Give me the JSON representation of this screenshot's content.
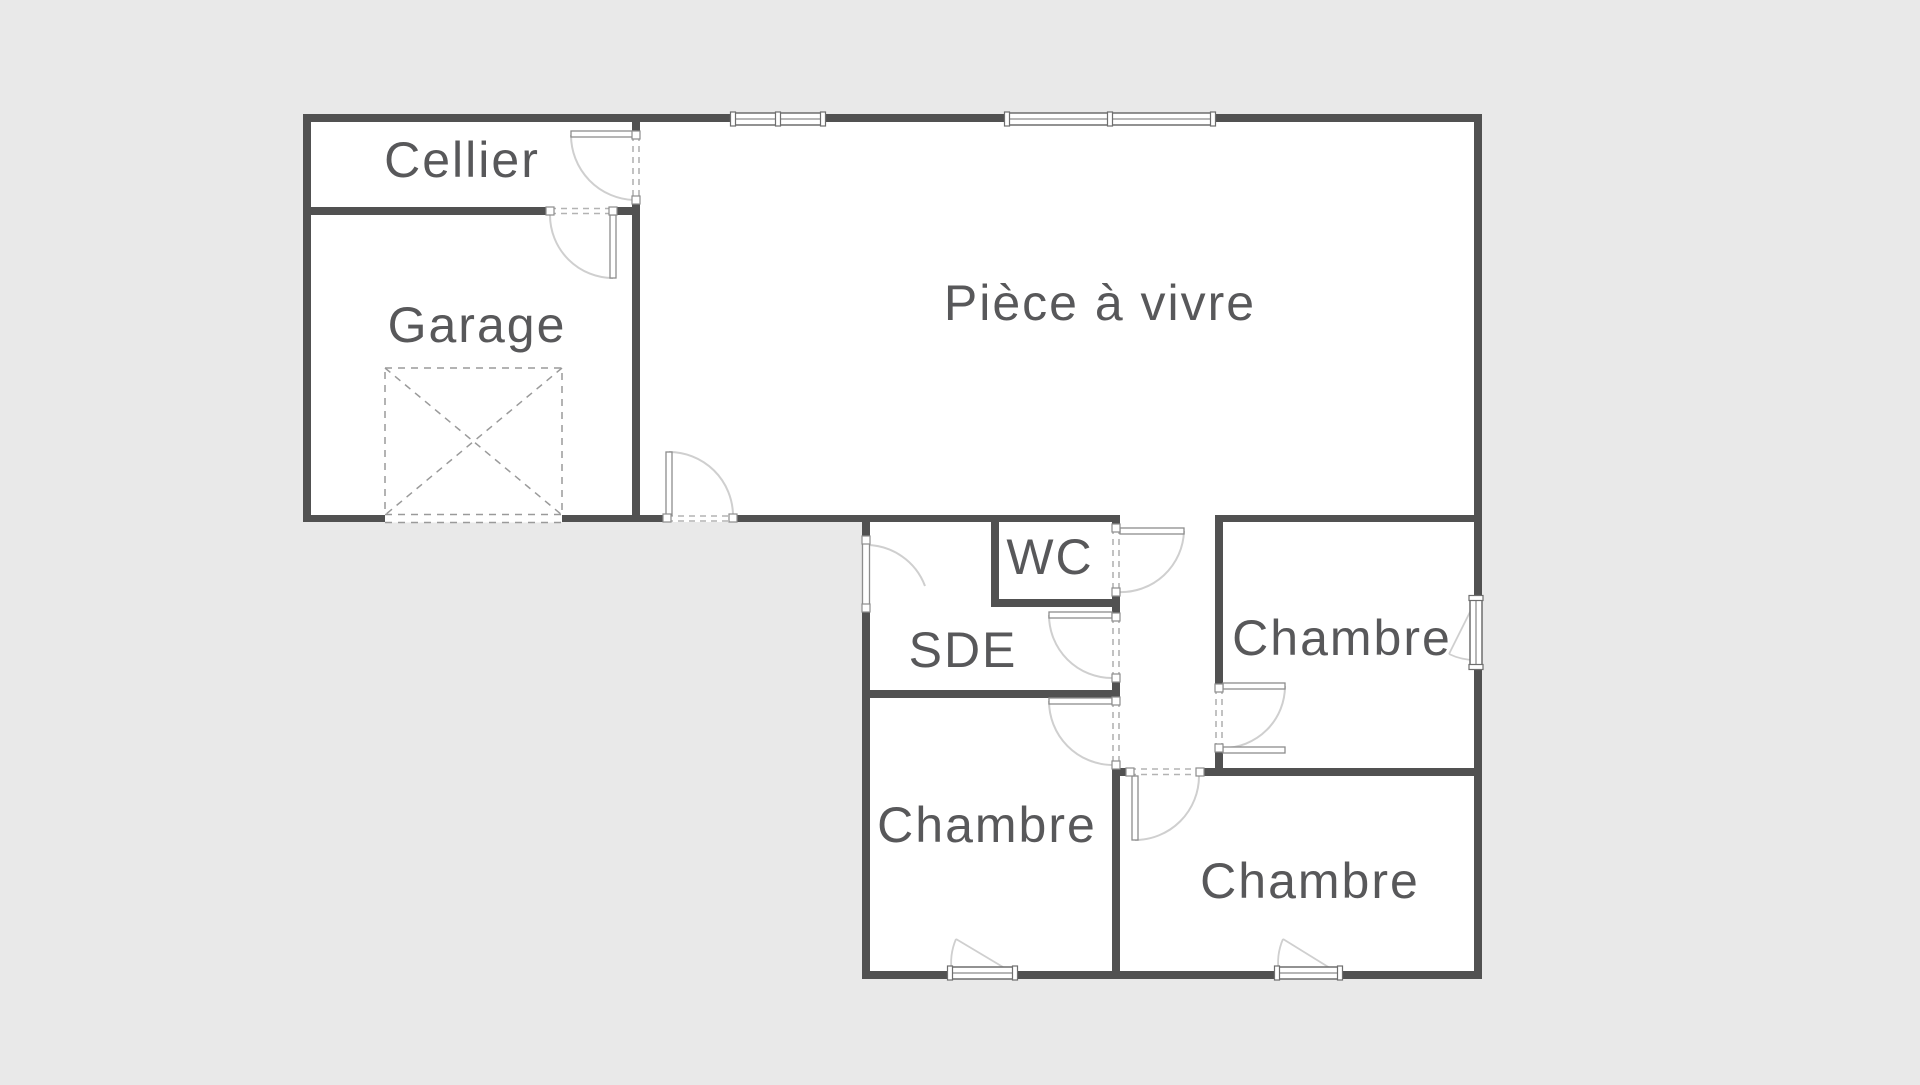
{
  "title": "floor-plan",
  "colors": {
    "background": "#e9e9e9",
    "floor": "#ffffff",
    "wall": "#515151",
    "label": "#58585a",
    "arc": "#cfcfcf",
    "dash": "#b3b3b3",
    "window_stroke": "#6e6e6e",
    "leaf_stroke": "#8d8d8d",
    "parking_dash": "#9a9a9a"
  },
  "label_font_size": 50,
  "rooms": [
    {
      "id": "cellier",
      "label": "Cellier",
      "cx": 462,
      "cy": 160
    },
    {
      "id": "garage",
      "label": "Garage",
      "cx": 477,
      "cy": 325
    },
    {
      "id": "piece-a-vivre",
      "label": "Pièce à vivre",
      "cx": 1100,
      "cy": 303
    },
    {
      "id": "wc",
      "label": "WC",
      "cx": 1050,
      "cy": 557
    },
    {
      "id": "sde",
      "label": "SDE",
      "cx": 963,
      "cy": 650
    },
    {
      "id": "chambre-droite",
      "label": "Chambre",
      "cx": 1342,
      "cy": 638
    },
    {
      "id": "chambre-bas-gauche",
      "label": "Chambre",
      "cx": 987,
      "cy": 825
    },
    {
      "id": "chambre-bas-droite",
      "label": "Chambre",
      "cx": 1310,
      "cy": 881
    }
  ],
  "floor_blocks": [
    {
      "x": 303,
      "y": 114,
      "w": 1179,
      "h": 408
    },
    {
      "x": 862,
      "y": 515,
      "w": 620,
      "h": 464
    }
  ],
  "walls": [
    {
      "x": 303,
      "y": 114,
      "w": 1179,
      "h": 8
    },
    {
      "x": 303,
      "y": 207,
      "w": 247,
      "h": 8
    },
    {
      "x": 613,
      "y": 207,
      "w": 27,
      "h": 8
    },
    {
      "x": 303,
      "y": 515,
      "w": 364,
      "h": 7
    },
    {
      "x": 733,
      "y": 515,
      "w": 387,
      "h": 7
    },
    {
      "x": 1215,
      "y": 515,
      "w": 267,
      "h": 7
    },
    {
      "x": 991,
      "y": 599,
      "w": 129,
      "h": 8
    },
    {
      "x": 862,
      "y": 690,
      "w": 258,
      "h": 8
    },
    {
      "x": 1112,
      "y": 768,
      "w": 18,
      "h": 8
    },
    {
      "x": 1200,
      "y": 768,
      "w": 282,
      "h": 8
    },
    {
      "x": 862,
      "y": 971,
      "w": 620,
      "h": 8
    },
    {
      "x": 303,
      "y": 114,
      "w": 8,
      "h": 408
    },
    {
      "x": 632,
      "y": 114,
      "w": 8,
      "h": 21
    },
    {
      "x": 632,
      "y": 200,
      "w": 8,
      "h": 315
    },
    {
      "x": 1474,
      "y": 114,
      "w": 8,
      "h": 865
    },
    {
      "x": 862,
      "y": 515,
      "w": 8,
      "h": 25
    },
    {
      "x": 862,
      "y": 608,
      "w": 8,
      "h": 363
    },
    {
      "x": 991,
      "y": 522,
      "w": 8,
      "h": 77
    },
    {
      "x": 1112,
      "y": 522,
      "w": 8,
      "h": 6
    },
    {
      "x": 1112,
      "y": 592,
      "w": 8,
      "h": 25
    },
    {
      "x": 1112,
      "y": 678,
      "w": 8,
      "h": 23
    },
    {
      "x": 1112,
      "y": 765,
      "w": 8,
      "h": 206
    },
    {
      "x": 1215,
      "y": 522,
      "w": 8,
      "h": 166
    },
    {
      "x": 1215,
      "y": 748,
      "w": 8,
      "h": 20
    }
  ],
  "parking_box": {
    "x": 385,
    "y": 368,
    "w": 177,
    "h": 147
  },
  "garage_door_band": {
    "x": 385,
    "y": 514.5,
    "w": 177,
    "h": 8
  },
  "doors": [
    {
      "id": "porte-cellier",
      "dashes": [
        [
          633,
          135,
          633,
          200
        ],
        [
          639,
          135,
          639,
          200
        ]
      ],
      "leaf": {
        "x": 571,
        "y": 131,
        "w": 65,
        "h": 6
      },
      "arc": "M571,135 A65,65 0 0 0 634,200",
      "jambs": [
        [
          636,
          135
        ],
        [
          636,
          200
        ]
      ]
    },
    {
      "id": "porte-garage",
      "dashes": [
        [
          550,
          208.5,
          613,
          208.5
        ],
        [
          550,
          213.5,
          613,
          213.5
        ]
      ],
      "leaf": {
        "x": 610,
        "y": 215,
        "w": 6,
        "h": 63
      },
      "arc": "M613,278 A63,63 0 0 1 550,215",
      "jambs": [
        [
          550,
          211
        ],
        [
          613,
          211
        ]
      ]
    },
    {
      "id": "porte-entree",
      "dashes": [
        [
          667,
          516,
          733,
          516
        ],
        [
          667,
          521,
          733,
          521
        ]
      ],
      "leaf": {
        "x": 666,
        "y": 452,
        "w": 6,
        "h": 63
      },
      "arc": "M669,452 A64,64 0 0 1 733,515",
      "jambs": [
        [
          667,
          518
        ],
        [
          733,
          518
        ]
      ]
    },
    {
      "id": "porte-wc",
      "dashes": [
        [
          1113,
          528,
          1113,
          592
        ],
        [
          1119,
          528,
          1119,
          592
        ]
      ],
      "leaf": {
        "x": 1120,
        "y": 528,
        "w": 64,
        "h": 6
      },
      "arc": "M1184,531 A63,63 0 0 1 1118,592",
      "jambs": [
        [
          1116,
          528
        ],
        [
          1116,
          592
        ]
      ]
    },
    {
      "id": "porte-sde-gauche",
      "dashes": [
        [
          863,
          540,
          863,
          608
        ],
        [
          869,
          540,
          869,
          608
        ]
      ],
      "closed_leaf": {
        "x": 862.5,
        "y": 540,
        "w": 7,
        "h": 68
      },
      "arc": "M866,545 A63,63 0 0 1 925,586",
      "jambs": [
        [
          866,
          540
        ],
        [
          866,
          608
        ]
      ]
    },
    {
      "id": "porte-sde-couloir",
      "dashes": [
        [
          1113,
          617,
          1113,
          678
        ],
        [
          1119,
          617,
          1119,
          678
        ]
      ],
      "leaf": {
        "x": 1049,
        "y": 612,
        "w": 63,
        "h": 6
      },
      "arc": "M1049,615 A63,63 0 0 0 1112,678",
      "jambs": [
        [
          1116,
          617
        ],
        [
          1116,
          678
        ]
      ]
    },
    {
      "id": "porte-chambre-bas-gauche",
      "dashes": [
        [
          1113,
          701,
          1113,
          765
        ],
        [
          1119,
          701,
          1119,
          765
        ]
      ],
      "leaf": {
        "x": 1049,
        "y": 698,
        "w": 63,
        "h": 6
      },
      "arc": "M1049,701 A64,64 0 0 0 1112,765",
      "jambs": [
        [
          1116,
          701
        ],
        [
          1116,
          765
        ]
      ]
    },
    {
      "id": "porte-chambre-bas-droite",
      "dashes": [
        [
          1130,
          769,
          1200,
          769
        ],
        [
          1130,
          774.5,
          1200,
          774.5
        ]
      ],
      "leaf": {
        "x": 1132,
        "y": 776,
        "w": 6,
        "h": 64
      },
      "arc": "M1135,840 A64,64 0 0 0 1199,776",
      "jambs": [
        [
          1130,
          772
        ],
        [
          1200,
          772
        ]
      ]
    },
    {
      "id": "porte-chambre-droite",
      "dashes": [
        [
          1216,
          688,
          1216,
          748
        ],
        [
          1222,
          688,
          1222,
          748
        ]
      ],
      "leaf": {
        "x": 1223,
        "y": 683,
        "w": 62,
        "h": 6
      },
      "extra_leaf": {
        "x": 1223,
        "y": 747,
        "w": 62,
        "h": 6
      },
      "arc": "M1285,686 A62,62 0 0 1 1223,748",
      "jambs": [
        [
          1219,
          688
        ],
        [
          1219,
          748
        ]
      ]
    }
  ],
  "windows": [
    {
      "id": "fenetre-sejour-1",
      "x": 733,
      "y": 113,
      "w": 90,
      "h": 12,
      "dir": "h",
      "units": 2
    },
    {
      "id": "fenetre-sejour-2",
      "x": 1007,
      "y": 113,
      "w": 206,
      "h": 12,
      "dir": "h",
      "units": 2
    },
    {
      "id": "fenetre-chambre-bas-gauche",
      "x": 950,
      "y": 967,
      "w": 65,
      "h": 12,
      "dir": "h",
      "units": 1,
      "leaf_line": [
        1013,
        973,
        956,
        939
      ],
      "swing_arc": "M956,939 A61,61 0 0 0 952,973"
    },
    {
      "id": "fenetre-chambre-bas-droite",
      "x": 1277,
      "y": 967,
      "w": 63,
      "h": 12,
      "dir": "h",
      "units": 1,
      "leaf_line": [
        1338,
        973,
        1283,
        939
      ],
      "swing_arc": "M1283,939 A60,60 0 0 0 1279,973"
    },
    {
      "id": "fenetre-chambre-droite",
      "x": 1470,
      "y": 598,
      "w": 12,
      "h": 69,
      "dir": "v",
      "units": 1,
      "leaf_line": [
        1476,
        600,
        1449,
        654
      ],
      "swing_arc": "M1449,654 A60,60 0 0 0 1476,660"
    }
  ]
}
